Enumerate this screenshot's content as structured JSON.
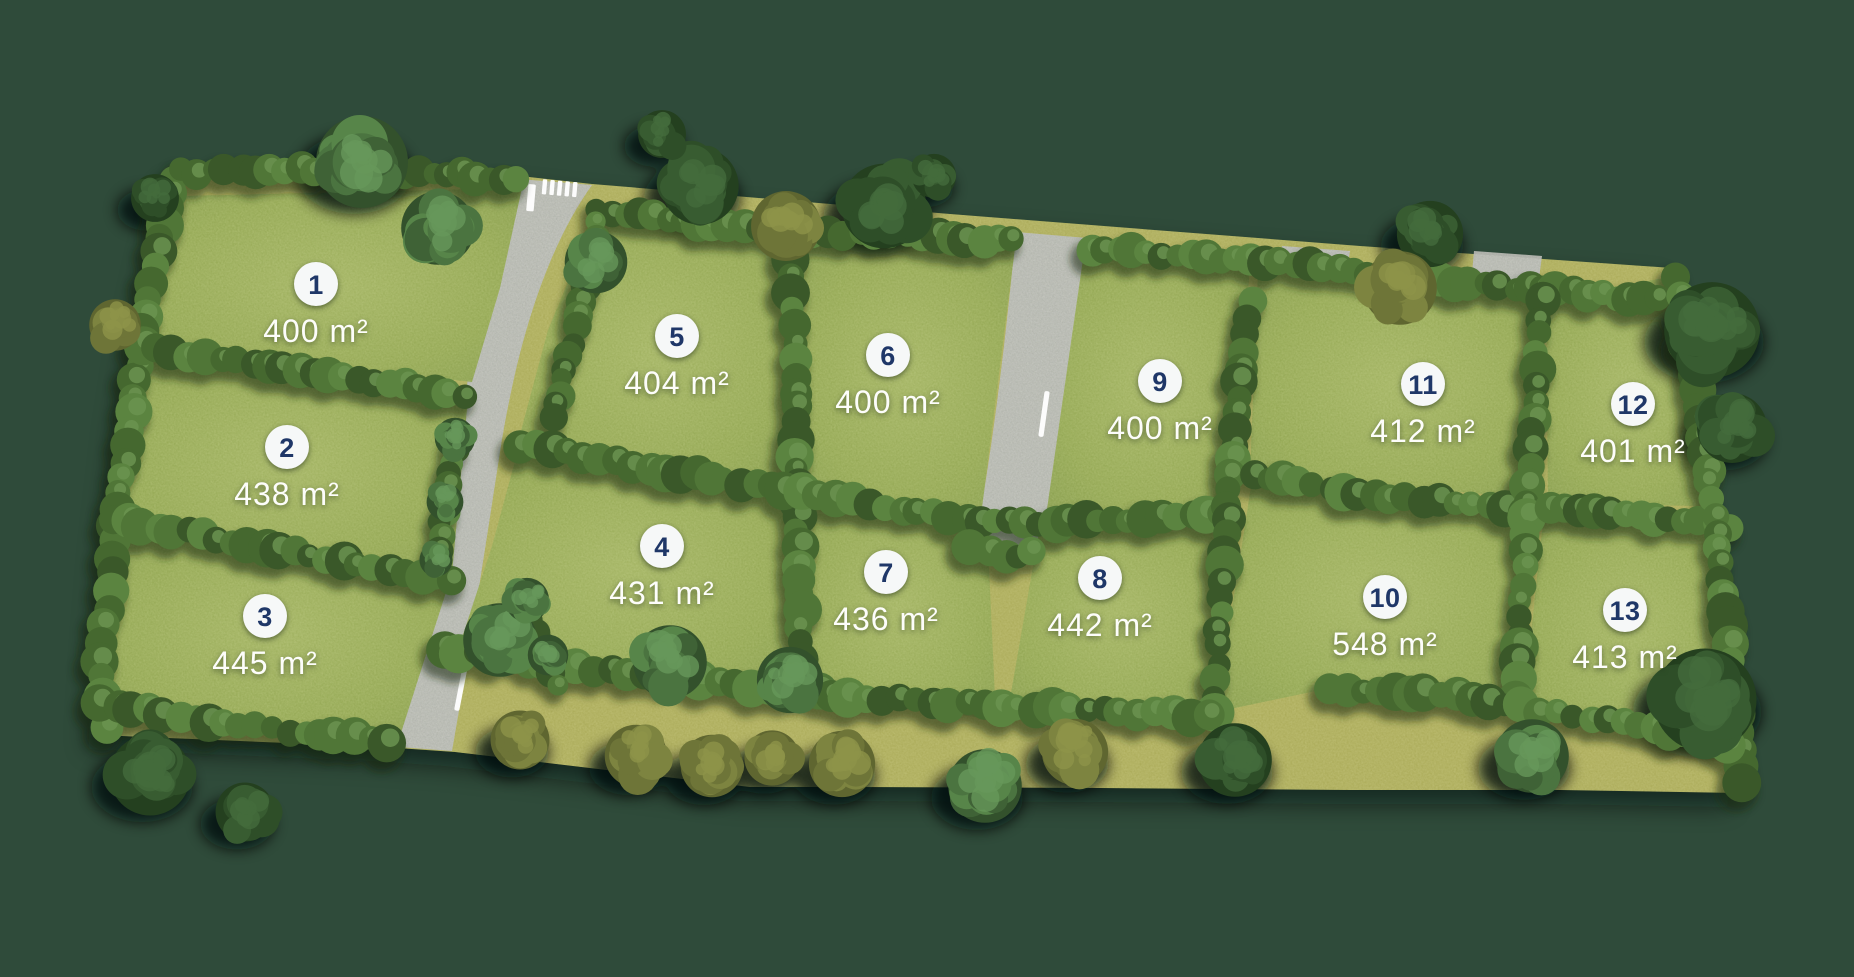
{
  "map": {
    "type": "residential-lot-subdivision-site-plan",
    "area_unit": "m²",
    "lot_count": 13
  },
  "lots": [
    {
      "number": "1",
      "area": "400 m²"
    },
    {
      "number": "2",
      "area": "438 m²"
    },
    {
      "number": "3",
      "area": "445 m²"
    },
    {
      "number": "4",
      "area": "431 m²"
    },
    {
      "number": "5",
      "area": "404 m²"
    },
    {
      "number": "6",
      "area": "400 m²"
    },
    {
      "number": "7",
      "area": "436 m²"
    },
    {
      "number": "8",
      "area": "442 m²"
    },
    {
      "number": "9",
      "area": "400 m²"
    },
    {
      "number": "10",
      "area": "548 m²"
    },
    {
      "number": "11",
      "area": "412 m²"
    },
    {
      "number": "12",
      "area": "401 m²"
    },
    {
      "number": "13",
      "area": "413 m²"
    }
  ],
  "colors": {
    "background": "#2f4b3a",
    "site_olive": "#a6a652",
    "lot_grass_light": "#9cae5a",
    "lot_grass": "#8da24c",
    "lot_grass_dark": "#7f9646",
    "road": "#bcbcb9",
    "road_marking": "#ffffff",
    "badge_bg": "#f6f8f8",
    "badge_number": "#1f3768",
    "area_text": "#fdfdfa",
    "hedge_shadow": "#16260e",
    "tree_ground_shadow": "#030f07",
    "hedge_palette": [
      "#3a5829",
      "#45682f",
      "#507637",
      "#5b8440"
    ],
    "hedge_light": "#6b9350",
    "tree_green_palette": [
      "#33512c",
      "#3f6236",
      "#4b7440",
      "#578549"
    ],
    "tree_green_light": "#66975a",
    "tree_dark_palette": [
      "#24401f",
      "#2e4e28",
      "#385c31"
    ],
    "tree_dark_light": "#446c3c",
    "tree_olive_palette": [
      "#5f6630",
      "#6e7538",
      "#7d8440"
    ],
    "tree_olive_light": "#8d9449"
  }
}
